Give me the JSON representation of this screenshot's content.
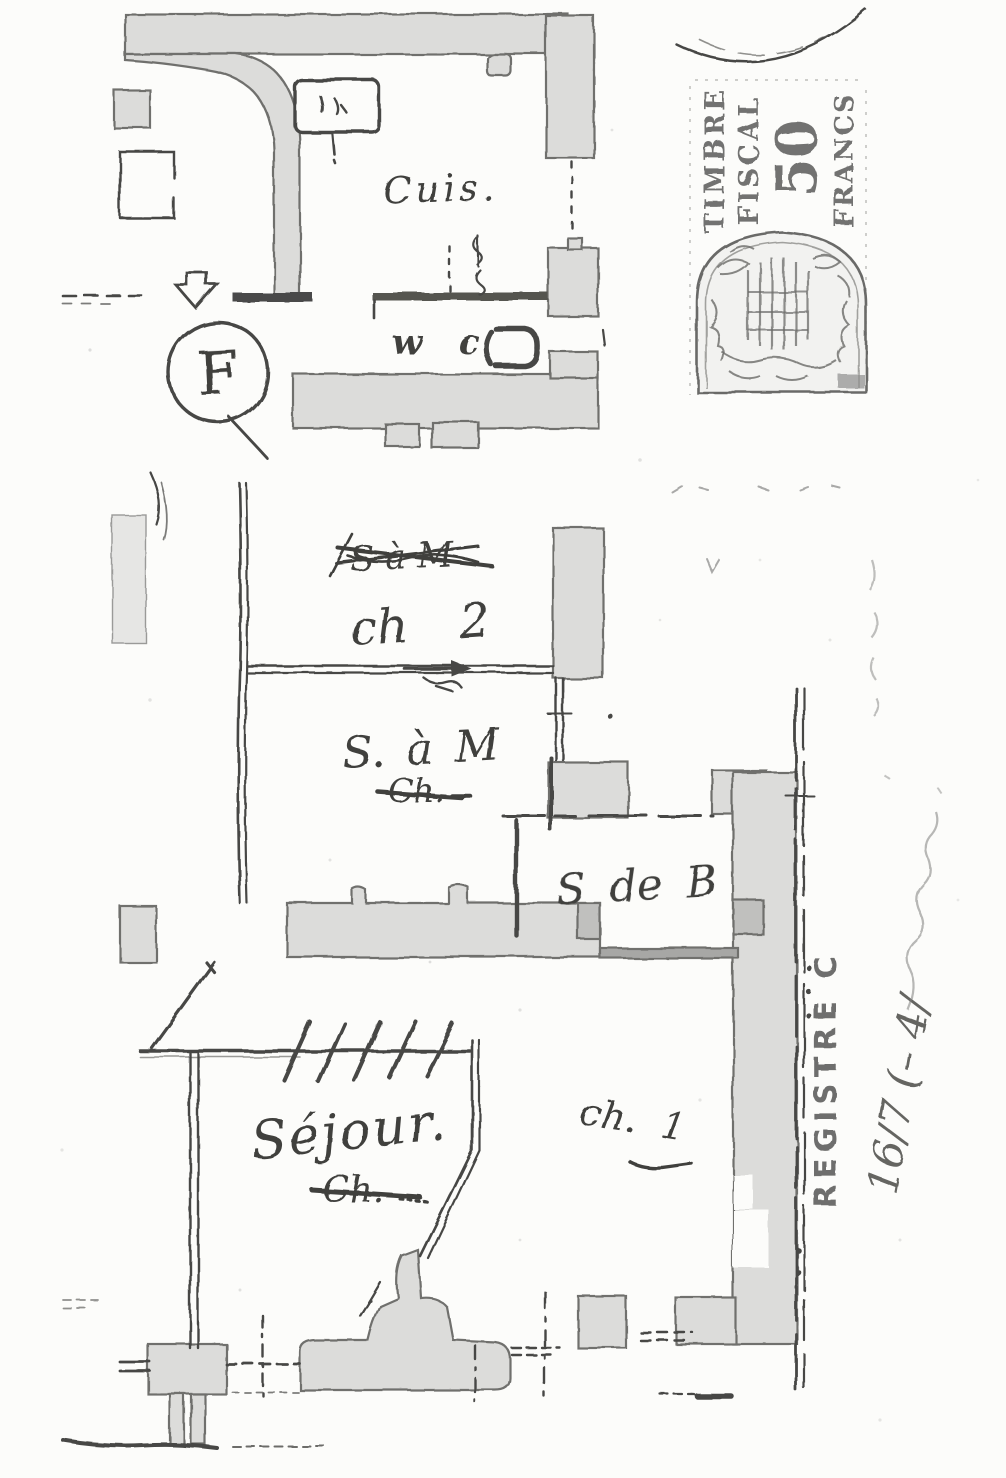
{
  "document": {
    "kind": "scanned hand-drawn apartment floor plan (photocopy)",
    "language": "French"
  },
  "plan": {
    "floor_letter": "F",
    "rooms": {
      "cuisine": {
        "label": "Cuis."
      },
      "wc": {
        "label": "w c"
      },
      "chambre2": {
        "label": "ch 2",
        "crossed_out": "S à M"
      },
      "salle_a_manger": {
        "label": "S. à M",
        "crossed_out": "Ch."
      },
      "salle_de_bains": {
        "label": "S de B"
      },
      "sejour": {
        "label": "Séjour.",
        "crossed_out": "Ch."
      },
      "chambre1": {
        "label": "ch. 1"
      }
    }
  },
  "stamp": {
    "title_line1": "TIMBRE",
    "title_line2": "FISCAL",
    "value": "50",
    "currency": "FRANCS"
  },
  "margin_annotations": {
    "registre": "REGISTRE C",
    "handwritten_reference": "16/7 (– 4/"
  },
  "colors": {
    "paper": "#fcfcfa",
    "ink": "#3f3f3d",
    "wall_fill": "#dcdcda",
    "stamp_ink": "#5a5a58"
  }
}
